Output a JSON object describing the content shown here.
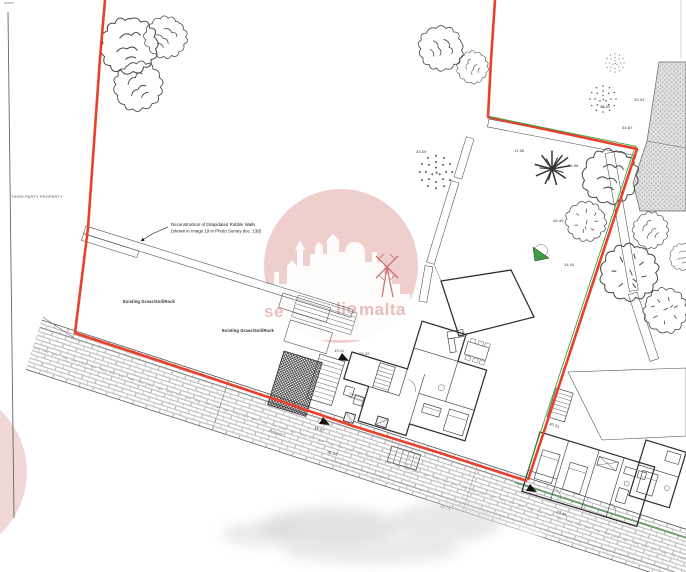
{
  "labels": {
    "third_party_property": "THIRD PARTY PROPERTY",
    "annotation_line1": "Reconstruction of Dilapidated Rubble Walls",
    "annotation_line2": "(shown in Image 19 in Photo Survey doc. 13d)",
    "existing_grass_1": "Existing Grass/Soil/Rock",
    "existing_grass_2": "Existing Grass/Soil/Rock",
    "footpath": "Footpath",
    "well_line1": "Covered Well",
    "well_line2": "(Soil/Rubble)"
  },
  "spot_levels": [
    {
      "v": "33.02"
    },
    {
      "v": "33.93"
    },
    {
      "v": "34.87"
    },
    {
      "v": "33.59"
    },
    {
      "v": "11.56"
    },
    {
      "v": "33.58"
    },
    {
      "v": "46.40"
    },
    {
      "v": "34.04"
    },
    {
      "v": "19.11"
    },
    {
      "v": "19.22"
    },
    {
      "v": "40.31"
    },
    {
      "v": "41.04"
    },
    {
      "v": "22.74"
    },
    {
      "v": "23.44"
    },
    {
      "v": "19.07"
    }
  ],
  "watermark": {
    "fragment_1": "se",
    "fragment_2": "lio",
    "fragment_3": "malta"
  },
  "colors": {
    "boundary-red": "#e8402c",
    "survey-green": "#3aa33f",
    "watermark-pink": "#d98b8b"
  }
}
